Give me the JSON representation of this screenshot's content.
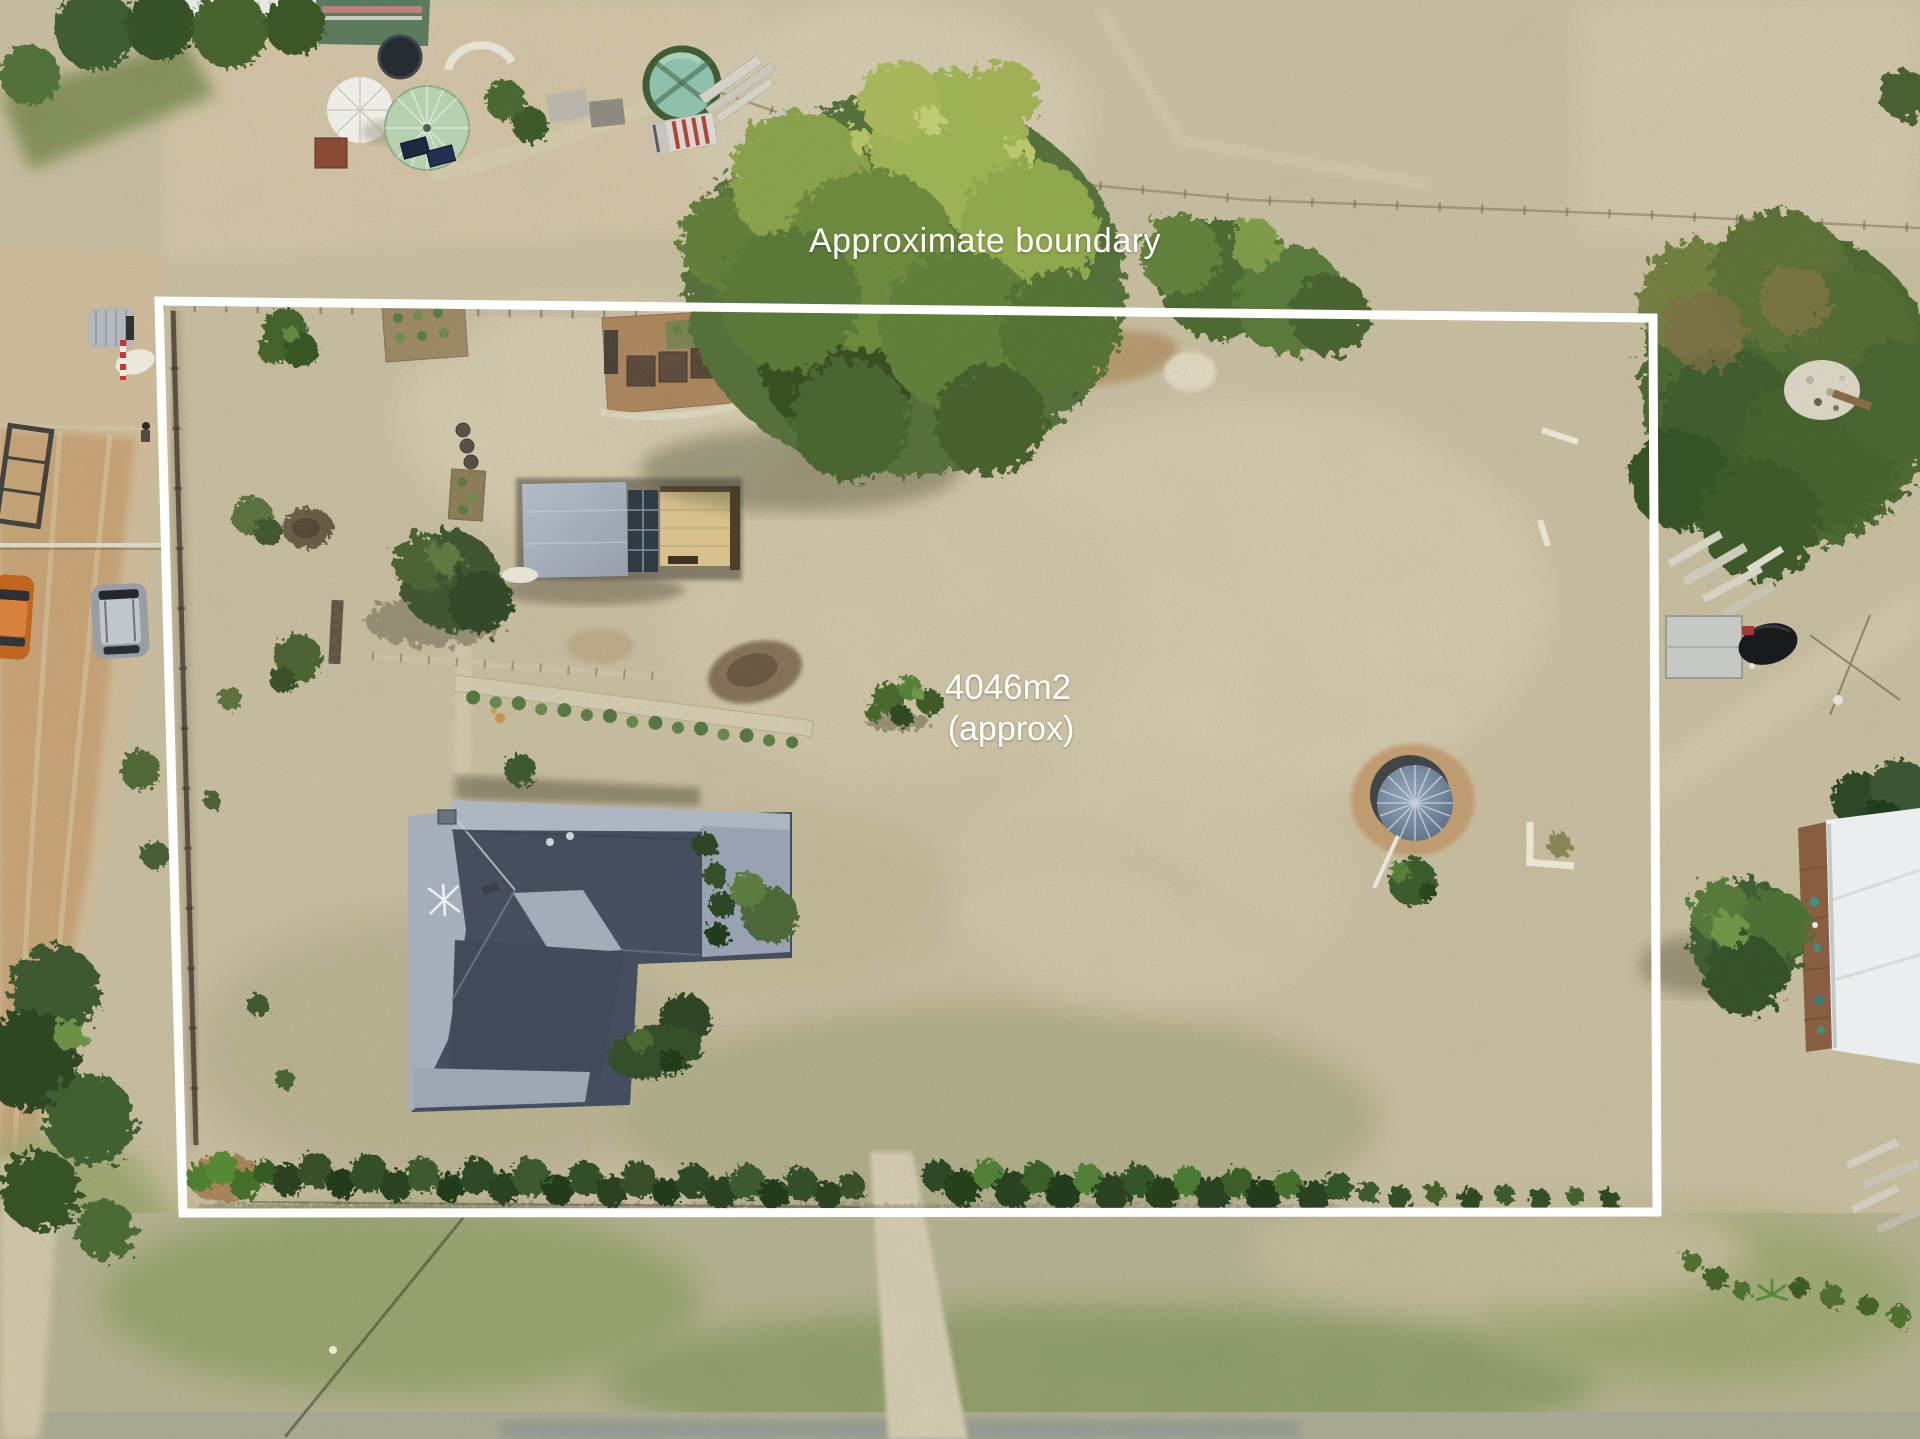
{
  "annotations": {
    "boundary_label": "Approximate boundary",
    "area_value": "4046m2",
    "area_qualifier": "(approx)",
    "text_color": "#ffffff",
    "boundary_line_color": "#ffffff"
  },
  "palette": {
    "dry_grass": "#cbbf9f",
    "green_grass": "#8f9e63",
    "dirt_road": "#c89a66",
    "house_roof_dark": "#454e5e",
    "house_roof_light": "#a7b0bd",
    "shed_roof": "#aab3b8",
    "gazebo_roof": "#6d819a",
    "tree_foliage": "#4e6a33",
    "big_tree_foliage": "#8aa24c"
  }
}
